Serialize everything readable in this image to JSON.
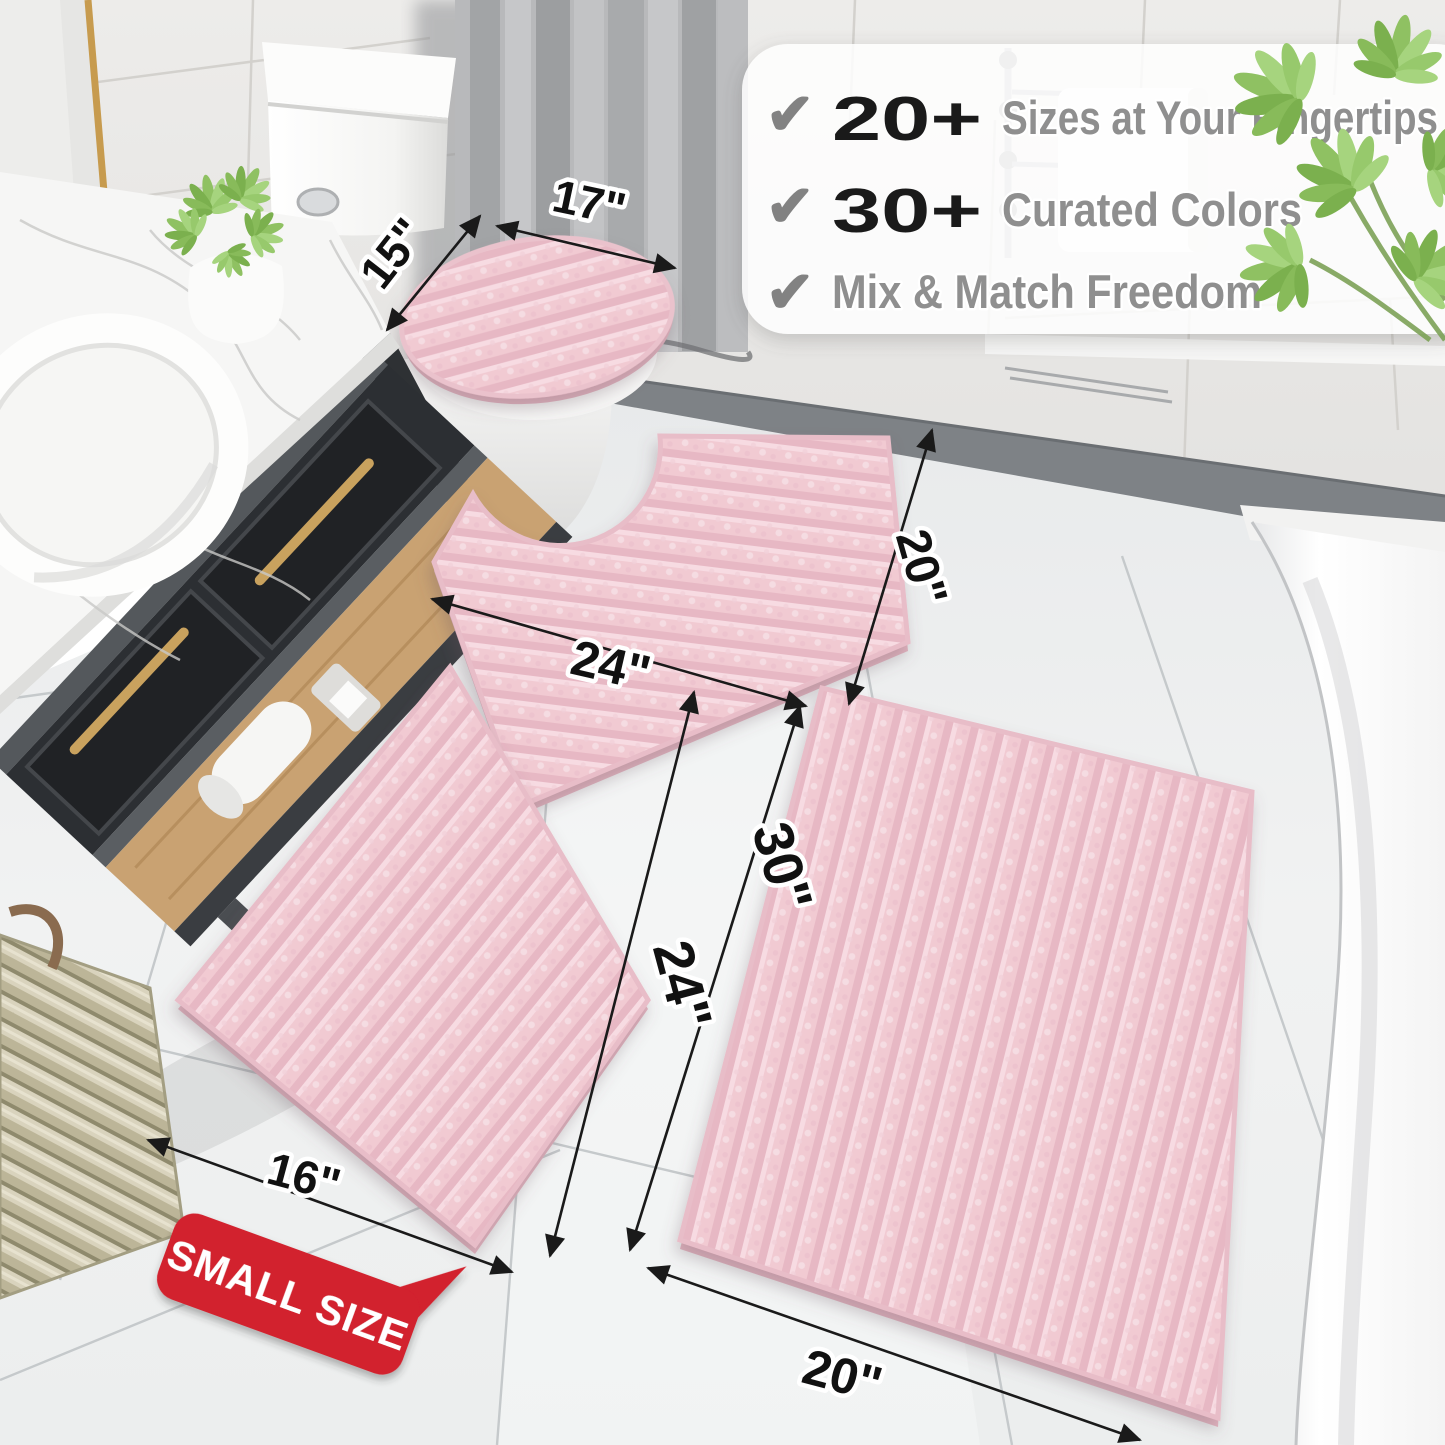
{
  "callout": {
    "rows": [
      {
        "check": "✔",
        "stat": "20+",
        "label": "Sizes at Your Fingertips"
      },
      {
        "check": "✔",
        "stat": "30+",
        "label": "Curated Colors"
      },
      {
        "check": "✔",
        "stat": "",
        "label": "Mix & Match Freedom"
      }
    ]
  },
  "dimensions": {
    "lid_width": "17\"",
    "lid_depth": "15\"",
    "contour_width": "24\"",
    "contour_depth": "20\"",
    "small_width": "16\"",
    "small_length": "24\"",
    "large_length": "30\"",
    "large_width": "20\""
  },
  "badge": {
    "label": "SMALL SIZE"
  },
  "colors": {
    "mat_pink": "#f1cad2",
    "mat_pink_shadow": "#e7b8c4",
    "mat_pink_light": "#f7dbe2",
    "badge_red": "#d2202e",
    "dimension_line": "#1a1a1a",
    "feature_gray": "#8f8f8f",
    "stat_black": "#1a1a1a",
    "plant_green": "#8fc162",
    "gold": "#c79b4e"
  }
}
